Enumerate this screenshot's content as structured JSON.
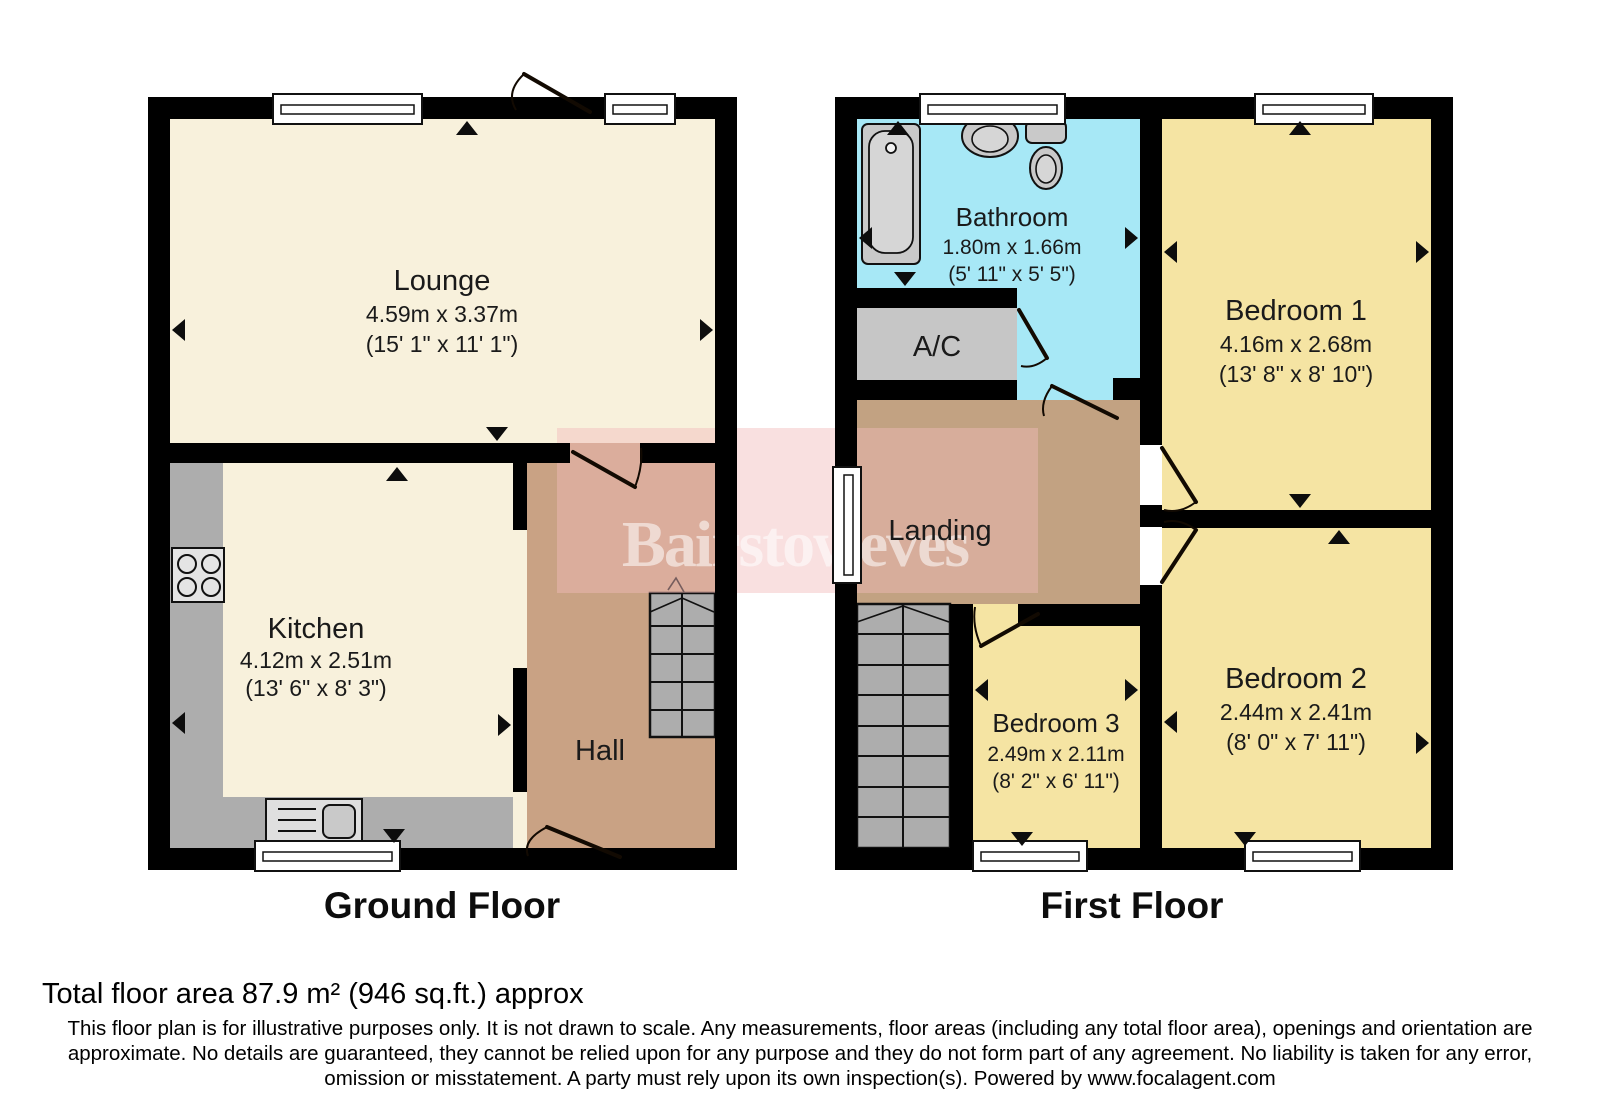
{
  "colors": {
    "wall": "#000000",
    "cream": "#F8F1DC",
    "yellow": "#F5E4A3",
    "cyan": "#A7E8F6",
    "hall_tan": "#C9A284",
    "landing_tan": "#C2A282",
    "stair_gray": "#ADADAD",
    "counter_gray": "#ADADAD",
    "ac_gray": "#C6C6C6",
    "fixture_gray": "#C9C9C9",
    "fixture_light": "#D6D6D6",
    "watermark_pink": "#F2BBBB",
    "white": "#FFFFFF"
  },
  "watermark": {
    "text": "Bairstoweves"
  },
  "ground_floor": {
    "label": "Ground Floor",
    "rooms": {
      "lounge": {
        "name": "Lounge",
        "metric": "4.59m x 3.37m",
        "imperial": "(15' 1\" x 11' 1\")"
      },
      "kitchen": {
        "name": "Kitchen",
        "metric": "4.12m x 2.51m",
        "imperial": "(13' 6\" x 8' 3\")"
      },
      "hall": {
        "name": "Hall"
      }
    }
  },
  "first_floor": {
    "label": "First Floor",
    "rooms": {
      "bathroom": {
        "name": "Bathroom",
        "metric": "1.80m x 1.66m",
        "imperial": "(5' 11\" x 5' 5\")"
      },
      "ac": {
        "name": "A/C"
      },
      "landing": {
        "name": "Landing"
      },
      "bedroom1": {
        "name": "Bedroom 1",
        "metric": "4.16m x 2.68m",
        "imperial": "(13' 8\" x 8' 10\")"
      },
      "bedroom2": {
        "name": "Bedroom 2",
        "metric": "2.44m x 2.41m",
        "imperial": "(8' 0\" x 7' 11\")"
      },
      "bedroom3": {
        "name": "Bedroom 3",
        "metric": "2.49m x 2.11m",
        "imperial": "(8' 2\" x 6' 11\")"
      }
    }
  },
  "footer": {
    "total_area": "Total floor area 87.9 m² (946 sq.ft.) approx",
    "disclaimer": "This floor plan is for illustrative purposes only. It is not drawn to scale. Any measurements, floor areas (including any total floor area), openings and orientation are approximate. No details are guaranteed, they cannot be relied upon for any purpose and they do not form part of any agreement. No liability is taken for any error, omission or misstatement. A party must rely upon its own inspection(s). Powered by www.focalagent.com"
  }
}
